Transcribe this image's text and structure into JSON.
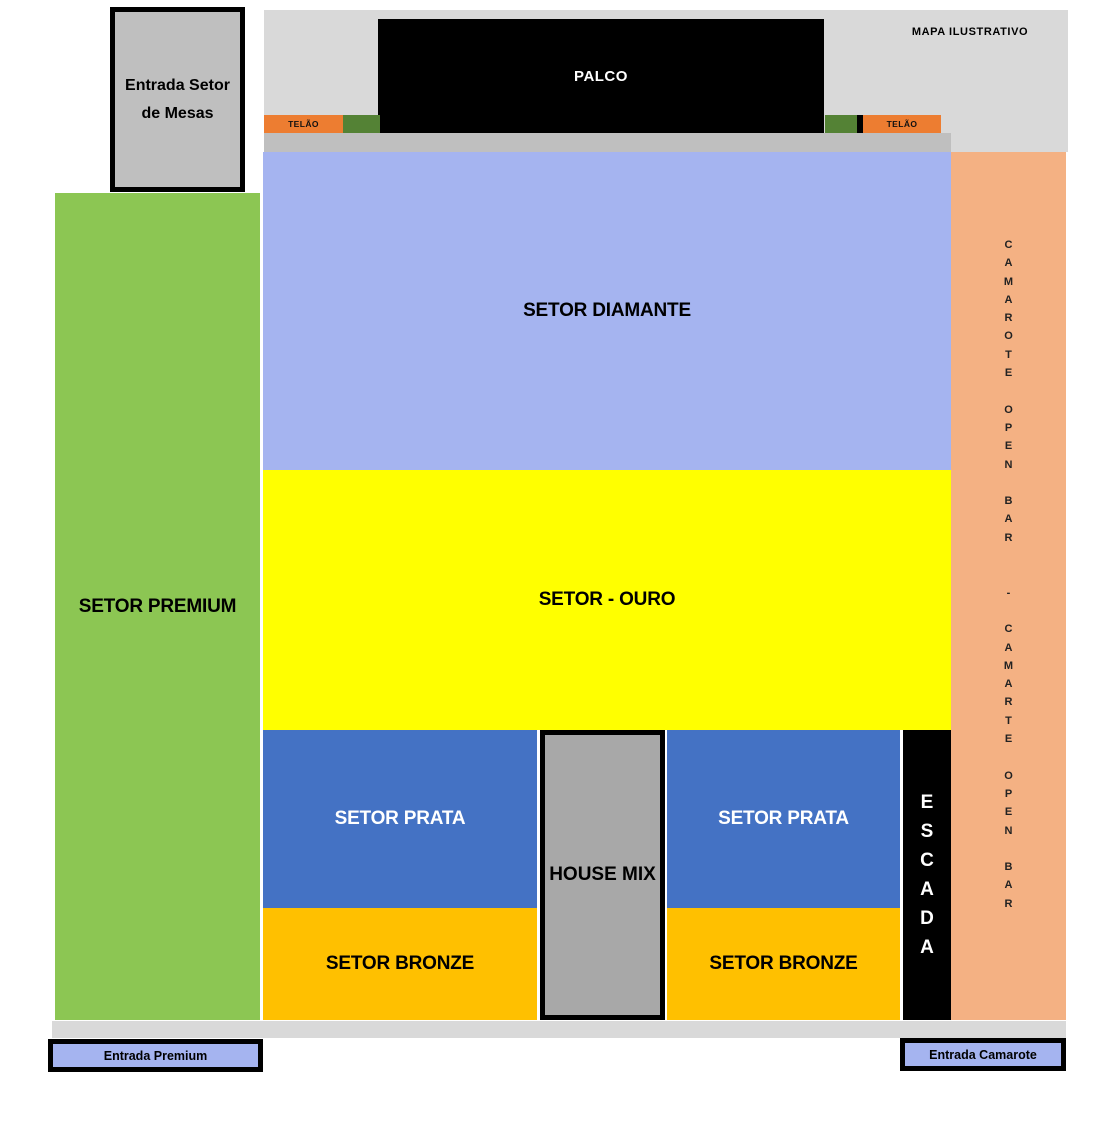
{
  "note": {
    "text": "MAPA ILUSTRATIVO"
  },
  "stage": {
    "label": "PALCO"
  },
  "screens": {
    "left_label": "TELÃO",
    "right_label": "TELÃO"
  },
  "sectors": {
    "diamante": {
      "label": "SETOR DIAMANTE"
    },
    "ouro": {
      "label": "SETOR - OURO"
    },
    "prata_left": {
      "label": "SETOR PRATA"
    },
    "prata_right": {
      "label": "SETOR PRATA"
    },
    "bronze_left": {
      "label": "SETOR BRONZE"
    },
    "bronze_right": {
      "label": "SETOR BRONZE"
    },
    "premium": {
      "label": "SETOR PREMIUM"
    },
    "house_mix": {
      "label": "HOUSE MIX"
    },
    "escada": {
      "label_vertical": "E\nS\nC\nA\nD\nA"
    },
    "camarote_open_bar": {
      "label_vertical": "C\nA\nM\nA\nR\nO\nT\nE\n\nO\nP\nE\nN\n\nB\nA\nR\n\n\n-\n\nC\nA\nM\nA\nR\nT\nE\n\nO\nP\nE\nN\n\nB\nA\nR"
    }
  },
  "entrances": {
    "mesas": {
      "label": "Entrada Setor\nde Mesas"
    },
    "premium": {
      "label": "Entrada Premium"
    },
    "camarote": {
      "label": "Entrada Camarote"
    }
  },
  "colors": {
    "stage_black": "#000000",
    "screen_orange": "#ED7D31",
    "screen_green": "#548235",
    "backdrop_gray": "#D9D9D9",
    "apron_gray": "#BFBFBF",
    "diamante_blue": "#A5B4F0",
    "ouro_yellow": "#FFFF00",
    "prata_blue": "#4472C4",
    "bronze_orange": "#FFC000",
    "premium_green": "#8CC653",
    "camarote_salmon": "#F4B183",
    "house_mix_gray": "#A8A8A8",
    "entrance_fill_blue": "#A5B4F0",
    "entrance_mesas_gray": "#BFBFBF"
  }
}
